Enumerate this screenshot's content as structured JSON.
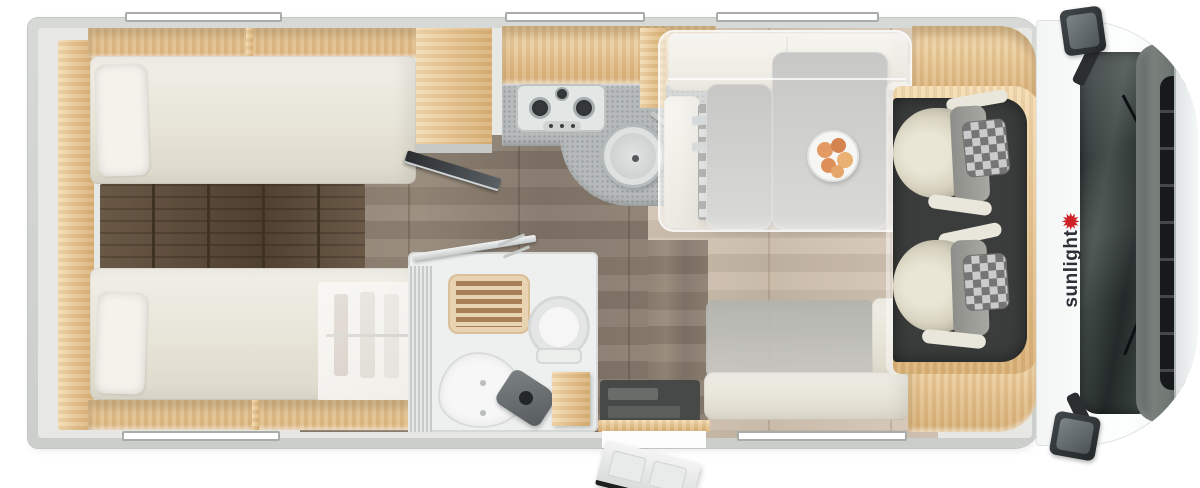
{
  "brand": {
    "logo_text": "sunlight",
    "sun_glyph": "✹",
    "logo_color": "#2e2f37",
    "sun_color": "#cf2027"
  },
  "palette": {
    "background": "#ffffff",
    "wall_grey": "#d2d5d2",
    "wood_light_oak": "#e8c795",
    "wood_dark_steps": "#5e4d3b",
    "floor_corridor": "#8b7e70",
    "floor_dinette": "#cec0af",
    "mattress_cream": "#ecebe2",
    "counter_grey": "#b6baba",
    "cab_mat": "#3b3d3c",
    "windshield": "#2a3133",
    "accent_red": "#cf2027"
  },
  "rooms": [
    {
      "id": "rear-bedroom",
      "label": "twin-single-beds"
    },
    {
      "id": "wardrobe",
      "label": "underbed-wardrobe"
    },
    {
      "id": "kitchen",
      "label": "kitchen-block"
    },
    {
      "id": "bathroom",
      "label": "compact-washroom"
    },
    {
      "id": "entry",
      "label": "entrance-door"
    },
    {
      "id": "dinette",
      "label": "dinette-with-drop-down-bed"
    },
    {
      "id": "cab",
      "label": "driver-cab"
    }
  ],
  "furniture": [
    "single-bed-top",
    "single-bed-bottom",
    "bed-steps",
    "wardrobe-hanging-rail",
    "overhead-shelves",
    "tv-on-bracket",
    "gas-hob-3-burner",
    "round-sink",
    "shower-tray",
    "cassette-toilet",
    "washbasin",
    "vanity-cabinet",
    "dinette-table",
    "fruit-plate",
    "bench-seat",
    "side-sofa",
    "drop-down-bed",
    "captain-seat-front",
    "captain-seat-rear",
    "windscreen",
    "side-mirror-top",
    "side-mirror-bottom",
    "entrance-door-open"
  ]
}
